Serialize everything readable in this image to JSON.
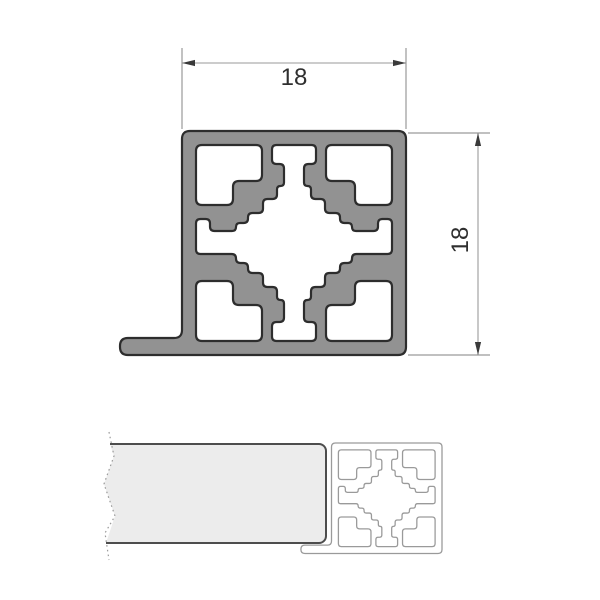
{
  "dimensions": {
    "width_label": "18",
    "height_label": "18"
  },
  "colors": {
    "profile_fill": "#929292",
    "profile_outline": "#2d2d2d",
    "cavity_fill": "#ffffff",
    "dim_line": "#9a9a9a",
    "dim_text": "#2f2f2f",
    "arrow": "#3a3a3a",
    "panel_fill": "#ececec",
    "panel_outline": "#4d4d4d",
    "outline_profile_stroke": "#9a9a9a",
    "break_line": "#9b9b9b",
    "background": "#ffffff"
  }
}
